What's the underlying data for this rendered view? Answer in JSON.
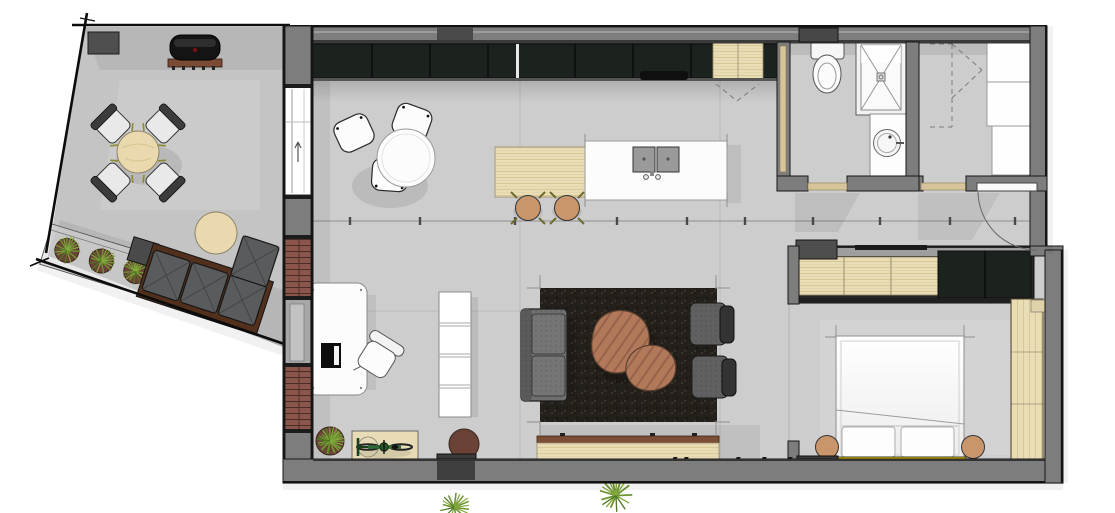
{
  "meta": {
    "title": "Apartment floor plan — top-down 3D render",
    "canvas": {
      "width": 1115,
      "height": 513
    }
  },
  "palette": {
    "wall": "#7d7d7d",
    "wallDark": "#3f3f3f",
    "line": "#141414",
    "floor": "#c9c9c9",
    "terraceFloor": "#c4c4c4",
    "cabinet": "#1c231e",
    "woodLight": "#e9ddb6",
    "woodMid": "#b1795a",
    "brick": "#8a564c",
    "rug": "#24201b",
    "sofa": "#6f6f6f",
    "outdoorSofa": "#595b5c",
    "whiteF": "#fcfcfc",
    "tan": "#c9966b",
    "accentYellow": "#f2cf00",
    "plant": "#7fa33c",
    "pot": "#6b4236",
    "bike": "#2f6b35"
  },
  "rooms": {
    "terrace": {
      "label": "Terrace",
      "furniture": [
        "storage box",
        "bbq grill",
        "round dining table",
        "4 outdoor chairs",
        "planter box with 3 plants",
        "round side table",
        "corner outdoor sofa"
      ]
    },
    "kitchen": {
      "label": "Kitchen",
      "furniture": [
        "dark wall cabinet run",
        "wood cabinet",
        "cooktop",
        "kitchen island with double sink",
        "wood breakfast table",
        "2 bar stools"
      ]
    },
    "living": {
      "label": "Living room",
      "furniture": [
        "round table with 3 chairs",
        "desk with monitor",
        "office chair",
        "shelf unit",
        "dark rug",
        "sofa",
        "2 organic coffee tables",
        "2 armchairs",
        "wood sideboard",
        "2 plants",
        "bicycle on mat",
        "doormat"
      ]
    },
    "bathroom": {
      "label": "Bathroom",
      "furniture": [
        "toilet",
        "shower with cross marking",
        "vanity with round basin"
      ]
    },
    "storage": {
      "label": "Storage room",
      "furniture": [
        "3 white cabinets",
        "folding door (dashed)",
        "swing door with arc"
      ]
    },
    "bedroom": {
      "label": "Bedroom",
      "furniture": [
        "wardrobe wood and dark sections",
        "double bed",
        "2 round nightstands",
        "yellow bed strip",
        "tall wood wardrobe",
        "radiator box"
      ]
    }
  }
}
